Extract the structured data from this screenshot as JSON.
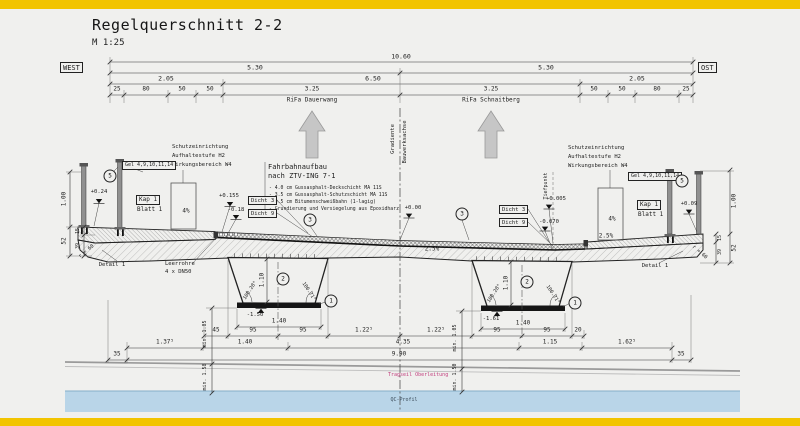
{
  "header": {
    "title": "Regelquerschnitt 2-2",
    "scale": "M 1:25"
  },
  "compass": {
    "west": "WEST",
    "ost": "OST"
  },
  "dims_top": {
    "total": "10.60",
    "left_half": "5.30",
    "right_half": "5.30",
    "left_cap": "2.05",
    "carriageway": "6.50",
    "right_cap": "2.05",
    "detail": [
      "25",
      "80",
      "50",
      "50",
      "3.25",
      "3.25",
      "50",
      "50",
      "80",
      "25"
    ],
    "rifa_left": "RiFa Dauerwang",
    "rifa_right": "RiFa Schnaitberg"
  },
  "axis": {
    "line1": "Gradiente",
    "line2": "Bauwerksachse",
    "tiefpunkt": "Tiefpunkt"
  },
  "pavement": {
    "title1": "Fahrbahnaufbau",
    "title2": "nach ZTV-ING 7-1",
    "layers": [
      "- 4.0 cm Gussasphalt-Deckschicht MA 11S",
      "- 3.5 cm Gussasphalt-Schutzschicht MA 11S",
      "- 0.5 cm Bitumenschweißbahn (1-lagig)",
      "- Grundierung und Versiegelung aus Epoxidharz"
    ]
  },
  "protection": {
    "line1": "Schutzeinrichtung",
    "line2": "Aufhaltestufe H2",
    "line3": "Wirkungsbereich W4"
  },
  "tags": {
    "gel": "Gel 4,9,10,11,14",
    "kap": "Kap 1",
    "blatt": "Blatt 1",
    "dicht3": "Dicht 3",
    "dicht9": "Dicht 9",
    "detail1": "Detail 1",
    "leerrohre1": "Leerrohre",
    "leerrohre2": "4 x DN50",
    "radius": "r = 60"
  },
  "callouts": {
    "n1": "1",
    "n2": "2",
    "n3": "3",
    "n5": "5"
  },
  "levels": {
    "left_edge": "+0.24",
    "left_road": "+0.155",
    "left_seal": "-0.18",
    "center": "+0.00",
    "tief_top": "+0.005",
    "tief_bottom": "-0.070",
    "right_edge": "+0.09",
    "box_left": "-1.50",
    "box_right": "-1.61"
  },
  "slopes": {
    "cap": "4%",
    "deck": "2.5%"
  },
  "box_girder": {
    "height": "1.10",
    "angle_l": "100.28°",
    "angle_r": "100.71°"
  },
  "dims_bottom": {
    "box_width": "1.40",
    "rowA": [
      "45",
      "95",
      "95",
      "1.22⁵",
      "1.22⁵",
      "95",
      "95",
      "20"
    ],
    "rowB": [
      "1.37⁵",
      "1.40",
      "4.35",
      "1.15",
      "1.62⁵"
    ],
    "rowC": [
      "35",
      "9.90",
      "35"
    ],
    "clear_left_1": "min. 1.05",
    "clear_left_2": "min. 1.58",
    "clear_right_1": "min. 1.05",
    "clear_right_2": "min. 1.50"
  },
  "dims_side": {
    "rail": "1.00",
    "cap_edge": "15",
    "beam": "52",
    "lower": "39"
  },
  "ground": {
    "wire": "Tragseil Oberleitung",
    "water": "QC-Profil"
  }
}
